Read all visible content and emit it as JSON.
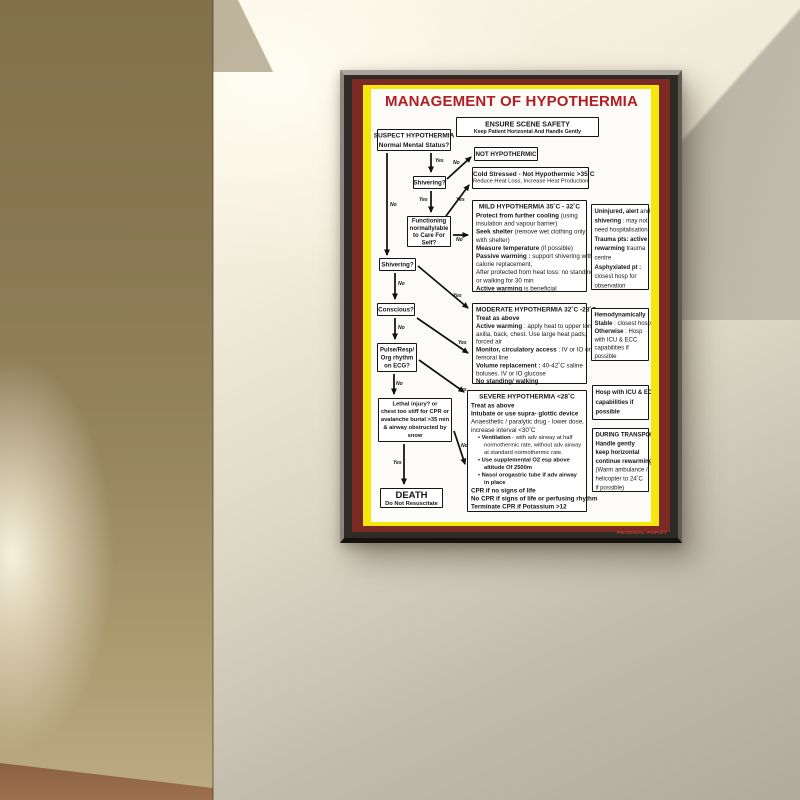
{
  "poster": {
    "title": "MANAGEMENT OF HYPOTHERMIA",
    "credit": "PRODIGAL-POPIST",
    "ensure": {
      "title": "ENSURE SCENE SAFETY",
      "sub": "Keep Patient Horizontal And Handle Gently"
    },
    "nodes": {
      "suspect": {
        "lines": [
          "SUSPECT HYPOTHERMIA",
          "Normal Mental Status?"
        ]
      },
      "not_hypothermic": {
        "title": "NOT HYPOTHERMIC"
      },
      "shivering1": {
        "title": "Shivering?"
      },
      "cold_stressed": {
        "title": "Cold Stressed - Not Hypothermic >35˚C",
        "sub": "Reduce Heat Loss, Increase Heat Production"
      },
      "functioning": {
        "lines": [
          "Functioning",
          "normally/able",
          "to Care For",
          "Self?"
        ]
      },
      "mild": {
        "title": "MILD HYPOTHERMIA  35˚C - 32˚C",
        "lines": [
          {
            "b": "Protect from further cooling ",
            "r": "(using"
          },
          {
            "r": "insulation and vapour barrier)"
          },
          {
            "b": "Seek shelter ",
            "r": "(remove wet clothing only"
          },
          {
            "r": "with shelter)"
          },
          {
            "b": "Measure temperature ",
            "r": "(if possible)"
          },
          {
            "b": "Passive warming : ",
            "r": "support shivering with"
          },
          {
            "r": "calorie replacement,"
          },
          {
            "r": "After protected from heat loss: no standing"
          },
          {
            "r": "or walking for 30 min"
          },
          {
            "b": "Active warming ",
            "r": "is beneficial"
          }
        ]
      },
      "uninjured": {
        "lines": [
          {
            "b": "Uninjured, alert ",
            "r": "and"
          },
          {
            "b": "shivering ",
            "r": ": may not"
          },
          {
            "r": "need hospitalisation"
          },
          {
            "b": "Trauma pts: active"
          },
          {
            "b": "rewarming ",
            "r": "trauma"
          },
          {
            "r": "centre"
          },
          {
            "b": "Asphyxiated pt :"
          },
          {
            "r": "closest hosp for"
          },
          {
            "r": "observation"
          }
        ]
      },
      "shivering2": {
        "title": "Shivering?"
      },
      "conscious": {
        "title": "Conscious?"
      },
      "moderate": {
        "title": "MODERATE HYPOTHERMIA 32˚C -28˚C",
        "lines": [
          {
            "b": "Treat as above"
          },
          {
            "b": "Active warming ",
            "r": ": apply heat to upper torso,"
          },
          {
            "r": "axilla, back, chest. Use large heat pads,"
          },
          {
            "r": "forced air"
          },
          {
            "b": "Monitor, circulatory access ",
            "r": ": IV or IO or"
          },
          {
            "r": "femoral line"
          },
          {
            "b": "Volume replacement : ",
            "r": "40-42˚C saline"
          },
          {
            "r": "boluses. IV or IO glucose"
          },
          {
            "b": "No standing/ walking"
          }
        ]
      },
      "hemodynamic": {
        "lines": [
          {
            "b": "Hemodynamically"
          },
          {
            "b": "Stable ",
            "r": ": closest hosp"
          },
          {
            "b": "Otherwise ",
            "r": ": Hosp"
          },
          {
            "r": "with ICU & ECC"
          },
          {
            "r": "capabilities if"
          },
          {
            "r": "possible"
          }
        ]
      },
      "pulse_ecg": {
        "lines": [
          "Pulse/Resp/",
          "Org rhythm",
          "on ECG?"
        ]
      },
      "severe": {
        "title": "SEVERE HYPOTHERMIA <28˚C",
        "lines": [
          {
            "b": "Treat as above"
          },
          {
            "b": "Intubate or use supra- glottic device"
          },
          {
            "r": "Anaesthetic / paralytic drug - lower dose,"
          },
          {
            "r": "increase interval <30˚C"
          },
          {
            "t": "bullet",
            "b": "Ventilation ",
            "r": "- with adv airway at half"
          },
          {
            "t": "indent",
            "r": "normothermic rate, without adv airway"
          },
          {
            "t": "indent",
            "r": "at standard normothermic rate."
          },
          {
            "t": "bullet",
            "b": "Use supplemental O2 esp above"
          },
          {
            "t": "indent",
            "b": "altitude Of 2500m"
          },
          {
            "t": "bullet",
            "b": "Naso/ orogastric tube if adv airway"
          },
          {
            "t": "indent",
            "b": "in place"
          },
          {
            "b": "CPR if no signs of life"
          },
          {
            "b": "No CPR if signs of life or perfusing rhythm"
          },
          {
            "b": "Terminate CPR if Potassium >12"
          }
        ]
      },
      "hosp_icu": {
        "lines": [
          {
            "b": "Hosp with ICU & ECC"
          },
          {
            "b": "capabilities if"
          },
          {
            "b": "possible"
          }
        ]
      },
      "transport": {
        "lines": [
          {
            "b": "DURING TRANSPORT"
          },
          {
            "b": "Handle gently"
          },
          {
            "b": "keep horizontal"
          },
          {
            "b": "continue rewarming"
          },
          {
            "r": "(Warm ambulance /"
          },
          {
            "r": "helicopter to 24˚C"
          },
          {
            "r": "if possible)"
          }
        ]
      },
      "lethal": {
        "lines": [
          "Lethal injury? or",
          "chest too stiff for CPR or",
          "avalanche burial >35 min",
          "& airway obstructed by",
          "snow"
        ]
      },
      "death": {
        "title": "DEATH",
        "sub": "Do Not Resuscitate"
      }
    },
    "edge_labels": {
      "e1": "Yes",
      "e2": "No",
      "e3": "No",
      "e4": "Yes",
      "e5": "Yes",
      "e6": "No",
      "e7": "No",
      "e8": "Yes",
      "e9": "Yes",
      "e10": "No",
      "e11": "No",
      "e12": "Yes",
      "e13": "No",
      "e14": "Yes"
    },
    "colors": {
      "title_red": "#b01f24",
      "frame_maroon": "#7c2b24",
      "frame_yellow": "#f4e70a"
    }
  }
}
